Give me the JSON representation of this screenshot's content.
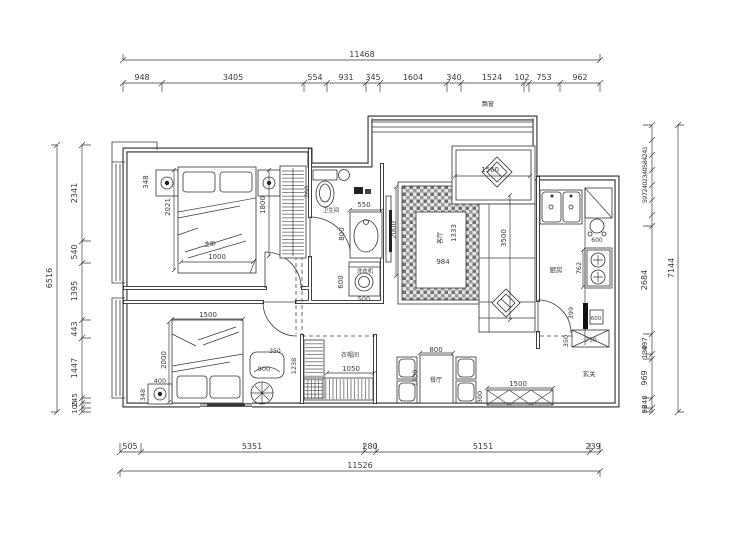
{
  "plan": {
    "dim_top": {
      "total": "11468",
      "segs": [
        "948",
        "3405",
        "554",
        "931",
        "345",
        "1604",
        "340",
        "1524",
        "102",
        "753",
        "962"
      ]
    },
    "dim_bottom": {
      "total": "11526",
      "segs": [
        "505",
        "5351",
        "280",
        "5151",
        "239"
      ]
    },
    "dim_left": {
      "total": "6516",
      "segs": [
        "2341",
        "540",
        "1395",
        "443",
        "1447",
        "245",
        "105"
      ]
    },
    "dim_right": {
      "total": "7144",
      "cluster": "5972402340584241",
      "segs": [
        "2684",
        "497",
        "130",
        "969",
        "240",
        "98"
      ]
    },
    "rooms": {
      "master": "主卧",
      "bathroom": "卫生间",
      "living": "客厅",
      "kitchen": "厨房",
      "dining": "餐厅",
      "closet": "衣帽间",
      "entry": "玄关",
      "bay_window": "飘窗",
      "washer": "洗衣机"
    },
    "master": {
      "d348": "348",
      "d2021": "2021",
      "d1800": "1800",
      "d1000": "1000"
    },
    "bathroom": {
      "d760": "760",
      "d550": "550",
      "d800": "800",
      "d600": "600",
      "d500": "500"
    },
    "living": {
      "d2000": "2000",
      "d984": "984",
      "d1333": "1333",
      "d1560": "1560",
      "d3500": "3500"
    },
    "kitchen": {
      "d762": "762",
      "d600a": "600",
      "d600b": "600",
      "d399": "399",
      "d350": "350",
      "d750": "750"
    },
    "entry": {
      "d1500": "1500",
      "d300": "300"
    },
    "dining": {
      "d800": "800",
      "d1200": "1200"
    },
    "bed2": {
      "d1500": "1500",
      "d2000": "2000",
      "d400": "400",
      "d348": "348",
      "d800": "800",
      "d350": "350",
      "d1238": "1238"
    },
    "closet": {
      "d1050": "1050"
    }
  }
}
